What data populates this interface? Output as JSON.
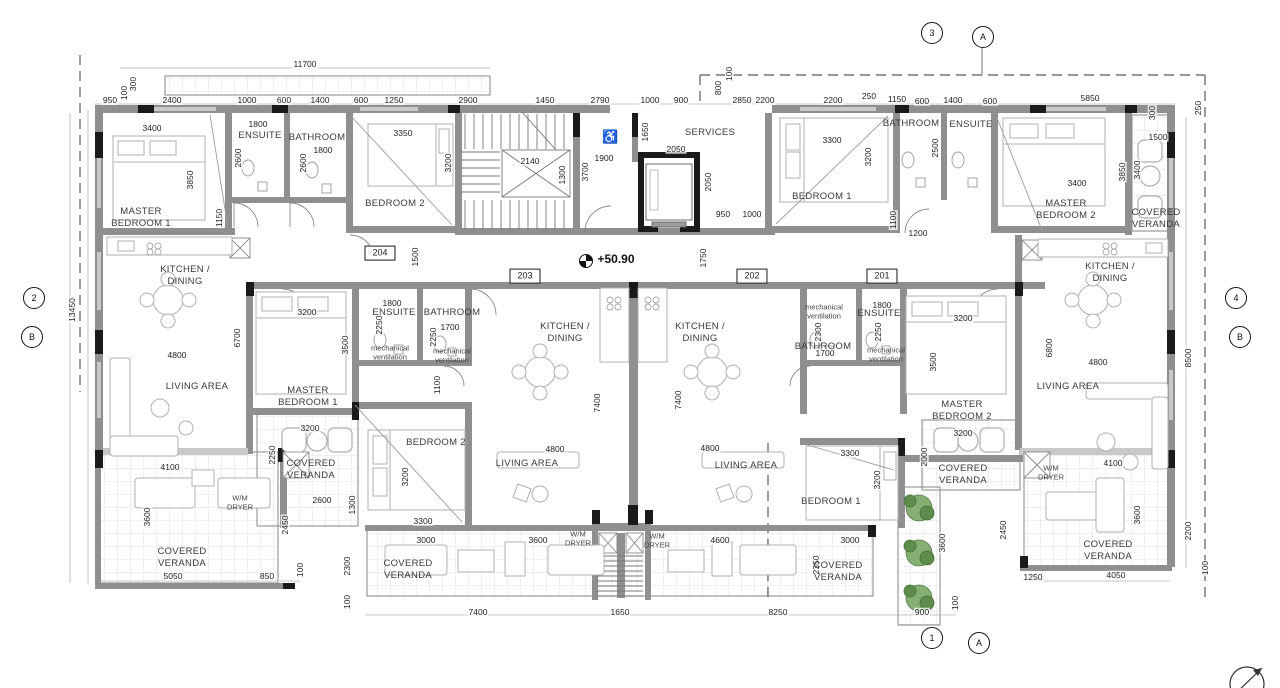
{
  "level": "+50.90",
  "tags": [
    "204",
    "203",
    "202",
    "201"
  ],
  "markers": [
    "3",
    "A",
    "2",
    "B",
    "4",
    "B",
    "1",
    "A"
  ],
  "accent": {
    "wall": "#8f8f8f",
    "black": "#1a1a1a",
    "tree": "#6f9c58",
    "line": "#777777"
  },
  "icons": [
    "wheelchair-icon",
    "section-marker-icon",
    "level-marker-icon",
    "tree-icon",
    "north-arrow-icon"
  ],
  "rooms": [
    "MASTER\nBEDROOM 1",
    "ENSUITE",
    "BATHROOM",
    "BEDROOM 2",
    "KITCHEN /\nDINING",
    "LIVING AREA",
    "COVERED\nVERANDA",
    "W/M\nDRYER",
    "COVERED\nVERANDA",
    "SERVICES",
    "BEDROOM 1",
    "BATHROOM",
    "ENSUITE",
    "MASTER\nBEDROOM 2",
    "COVERED\nVERANDA",
    "KITCHEN /\nDINING",
    "LIVING AREA",
    "W/M\nDRYER",
    "COVERED\nVERANDA",
    "MASTER\nBEDROOM 1",
    "ENSUITE",
    "mechanical\nventilation",
    "BATHROOM",
    "mechanical\nventilation",
    "BEDROOM 2",
    "KITCHEN /\nDINING",
    "LIVING AREA",
    "COVERED\nVERANDA",
    "W/M\nDRYER",
    "W/M\nDRYER",
    "KITCHEN /\nDINING",
    "LIVING AREA",
    "mechanical\nventilation",
    "ENSUITE",
    "BATHROOM",
    "mechanical\nventilation",
    "MASTER\nBEDROOM 2",
    "COVERED\nVERANDA",
    "BEDROOM 1",
    "COVERED\nVERANDA"
  ],
  "dims": [
    "11700",
    "950",
    "100",
    "300",
    "2400",
    "1000",
    "600",
    "1400",
    "600",
    "1250",
    "2900",
    "1450",
    "2790",
    "1000",
    "900",
    "2850",
    "800",
    "100",
    "2200",
    "2200",
    "250",
    "1150",
    "600",
    "1400",
    "600",
    "5850",
    "300",
    "1500",
    "250",
    "13450",
    "3400",
    "3850",
    "1150",
    "1800",
    "2600",
    "1800",
    "2600",
    "3350",
    "3200",
    "1500",
    "2140",
    "1300",
    "3700",
    "1900",
    "1650",
    "2050",
    "2050",
    "950",
    "1000",
    "1750",
    "3300",
    "3200",
    "1200",
    "1100",
    "2500",
    "3400",
    "3850",
    "3400",
    "6700",
    "4800",
    "4100",
    "3600",
    "5050",
    "850",
    "100",
    "2450",
    "2600",
    "1300",
    "2300",
    "100",
    "3200",
    "2250",
    "3200",
    "3500",
    "1800",
    "2250",
    "1700",
    "2250",
    "1100",
    "3200",
    "3300",
    "4800",
    "7400",
    "7400",
    "4800",
    "2300",
    "1700",
    "1800",
    "2250",
    "3500",
    "3200",
    "3300",
    "3200",
    "3200",
    "2000",
    "3000",
    "3600",
    "4600",
    "7400",
    "1650",
    "3000",
    "2350",
    "8250",
    "900",
    "100",
    "3600",
    "2450",
    "1250",
    "4050",
    "6800",
    "4800",
    "8500",
    "4100",
    "3600",
    "2200",
    "100"
  ]
}
